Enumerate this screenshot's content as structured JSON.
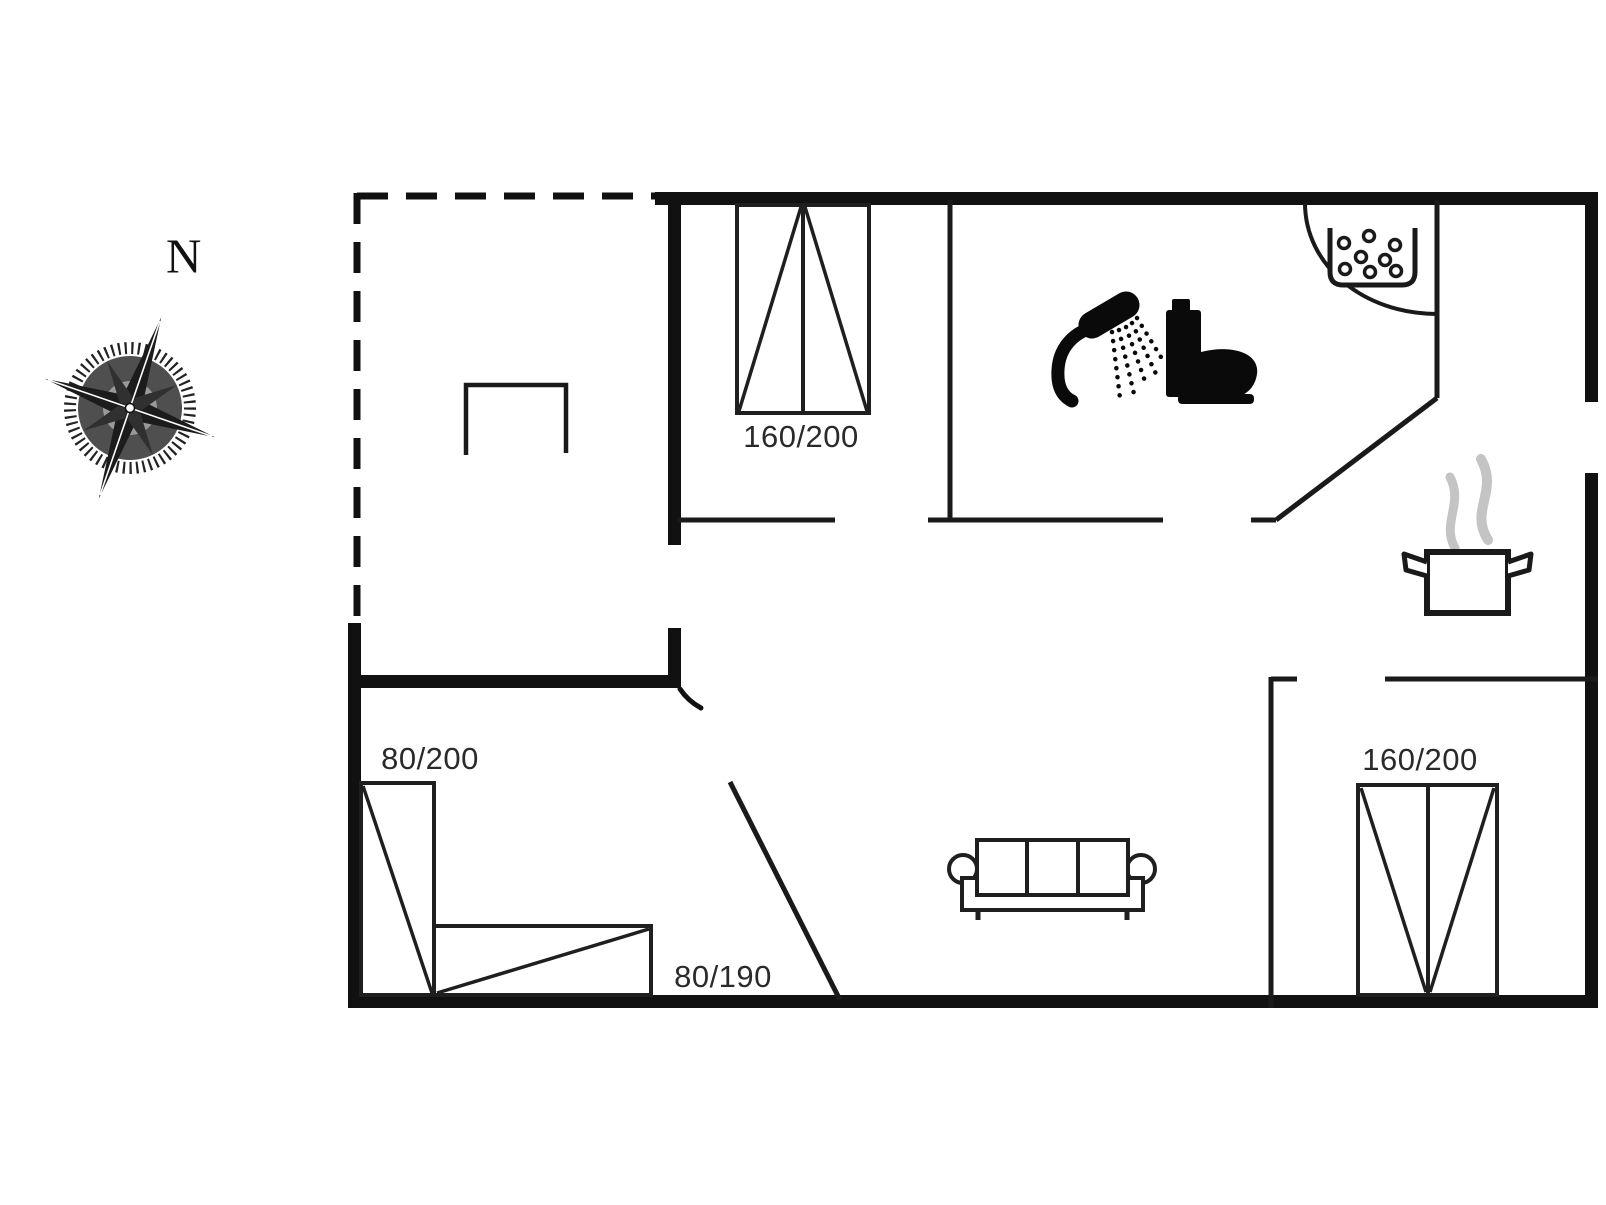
{
  "compass": {
    "label": "N"
  },
  "dimension_labels": {
    "bed_top_double": "160/200",
    "bed_left_single": "80/200",
    "bed_bottom_single": "80/190",
    "bed_right_double": "160/200"
  },
  "colors": {
    "wall": "#111111",
    "line": "#1a1a1a",
    "steam": "#c4c4c4",
    "text": "#2a2a2a",
    "background": "#ffffff"
  },
  "icons": [
    "compass-rose-icon",
    "shower-icon",
    "toilet-icon",
    "bubble-basin-icon",
    "steaming-pot-icon",
    "sofa-icon",
    "double-bed-icon",
    "single-bed-icon",
    "table-icon"
  ]
}
